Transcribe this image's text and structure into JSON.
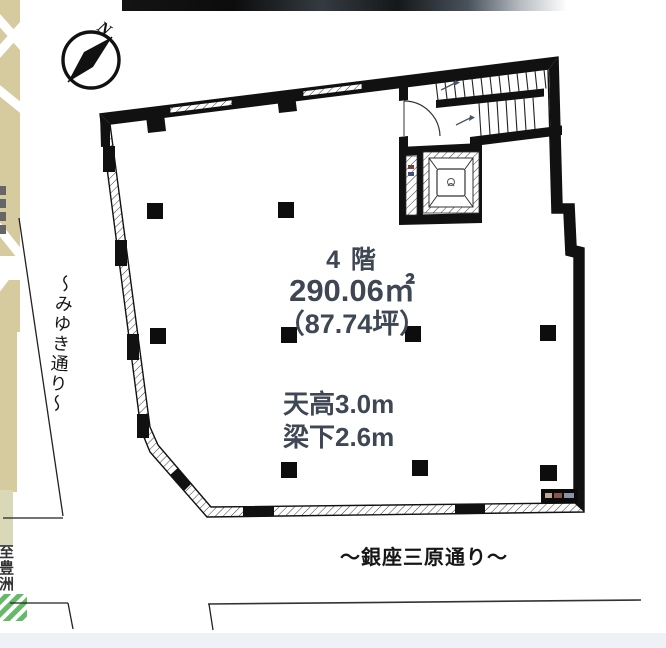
{
  "compass": {
    "north_label": "N"
  },
  "plan": {
    "floor_label": "4 階",
    "area_m2": "290.06㎡",
    "area_tsubo": "（87.74坪）",
    "ceiling_height": "天高3.0m",
    "under_beam": "梁下2.6m"
  },
  "streets": {
    "left_vertical": "～みゆき通り～",
    "bottom": "～銀座三原通り～"
  },
  "map": {
    "destination_label": "至豊洲"
  },
  "colors": {
    "spec_text": "#3f4754",
    "wall": "#111111",
    "map_beige": "#d5cb9f",
    "stripe_green": "#66b96a",
    "street_text": "#161616"
  }
}
